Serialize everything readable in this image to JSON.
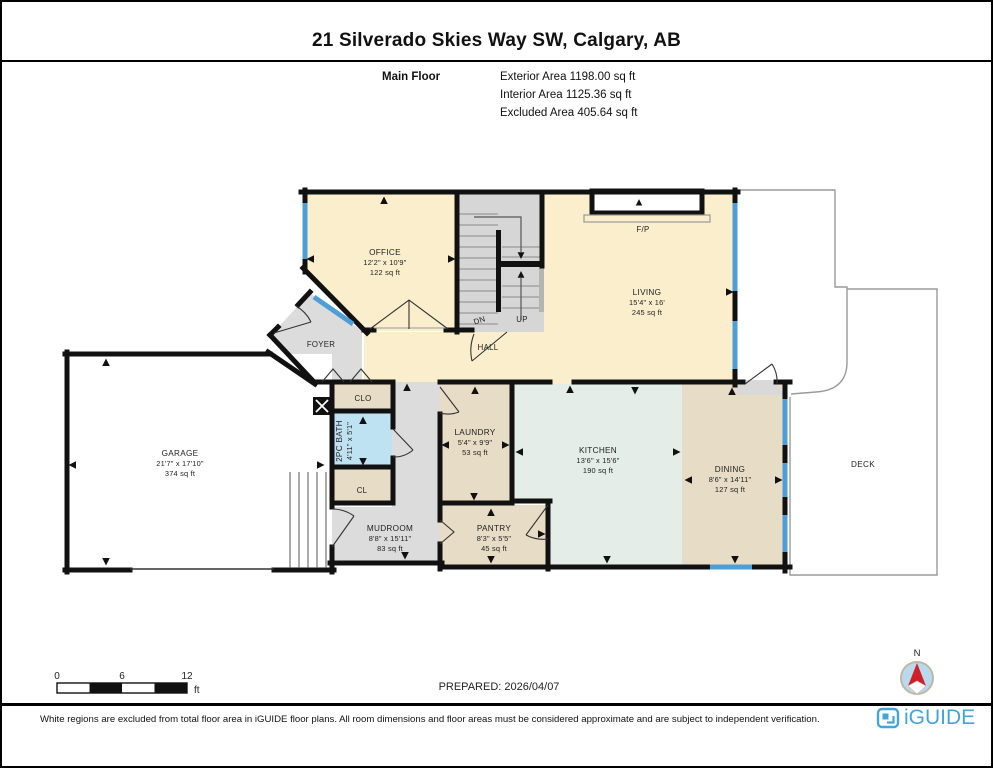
{
  "header": {
    "title": "21 Silverado Skies Way SW, Calgary, AB",
    "floor_label": "Main Floor",
    "exterior_area": "Exterior Area 1198.00 sq ft",
    "interior_area": "Interior Area 1125.36 sq ft",
    "excluded_area": "Excluded Area 405.64 sq ft"
  },
  "rooms": {
    "office": {
      "name": "OFFICE",
      "dims": "12'2\" x 10'9\"",
      "area": "122 sq ft"
    },
    "living": {
      "name": "LIVING",
      "dims": "15'4\" x 16'",
      "area": "245 sq ft"
    },
    "foyer": {
      "name": "FOYER"
    },
    "hall": {
      "name": "HALL"
    },
    "garage": {
      "name": "GARAGE",
      "dims": "21'7\" x 17'10\"",
      "area": "374 sq ft"
    },
    "closet": {
      "name": "CLO"
    },
    "bath": {
      "name": "2PC BATH",
      "dims": "4'11\" x 5'1\""
    },
    "closet2": {
      "name": "CL"
    },
    "mudroom": {
      "name": "MUDROOM",
      "dims": "8'8\" x 15'11\"",
      "area": "83 sq ft"
    },
    "laundry": {
      "name": "LAUNDRY",
      "dims": "5'4\" x 9'9\"",
      "area": "53 sq ft"
    },
    "pantry": {
      "name": "PANTRY",
      "dims": "8'3\" x 5'5\"",
      "area": "45 sq ft"
    },
    "kitchen": {
      "name": "KITCHEN",
      "dims": "13'6\" x 15'6\"",
      "area": "190 sq ft"
    },
    "dining": {
      "name": "DINING",
      "dims": "8'6\" x 14'11\"",
      "area": "127 sq ft"
    },
    "deck": {
      "name": "DECK"
    },
    "fireplace": {
      "name": "F/P"
    },
    "stairs_down": {
      "name": "DN"
    },
    "stairs_up": {
      "name": "UP"
    }
  },
  "scale_bar": {
    "tick_0": "0",
    "tick_6": "6",
    "tick_12": "12",
    "unit": "ft"
  },
  "prepared_label": "PREPARED: 2026/04/07",
  "compass": {
    "north_label": "N"
  },
  "footer": {
    "disclaimer": "White regions are excluded from total floor area in iGUIDE floor plans. All room dimensions and floor areas must be considered approximate and are subject to independent verification.",
    "brand": "iGUIDE"
  },
  "colors": {
    "wall": "#111111",
    "window": "#4d9fd6",
    "room_cream": "#faeecd",
    "room_tan": "#e7dcc6",
    "room_gray": "#dcdcdc",
    "room_mint": "#e4ede7",
    "room_blue": "#bfe2f2",
    "stairs": "#d6d6d6",
    "brand_blue": "#45a5d7",
    "compass_red": "#cf2027",
    "compass_fill": "#b9d9ee"
  }
}
